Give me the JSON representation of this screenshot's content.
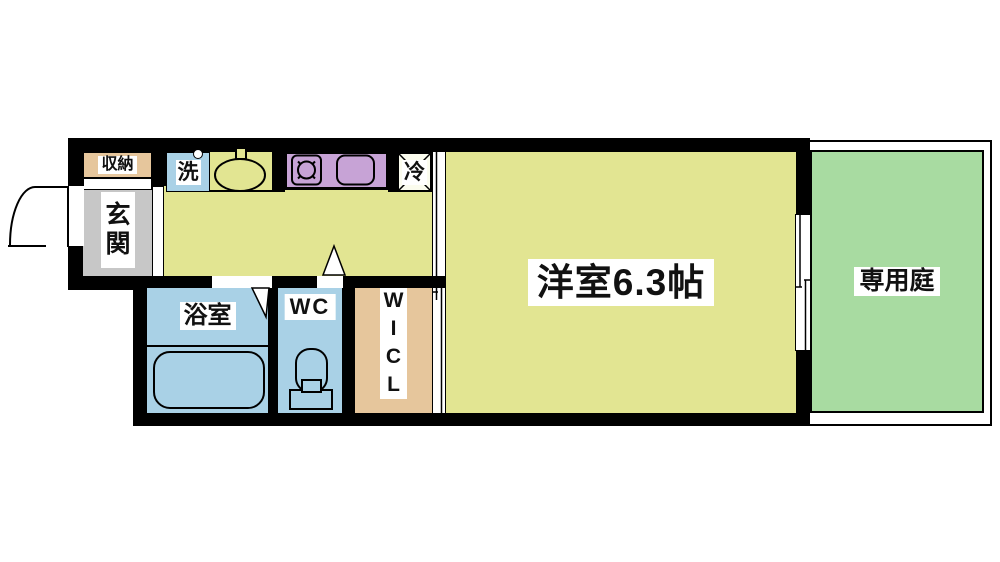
{
  "title": "1K apartment floor plan",
  "colors": {
    "wall": "#000000",
    "yellow": "#e2e592",
    "tan": "#e6c69c",
    "gray": "#c7c7c7",
    "blue": "#a9d1e6",
    "purple": "#c7a3d6",
    "green": "#a8dba1",
    "cream": "#fbfcee"
  },
  "rooms": {
    "storage": {
      "label": "収納"
    },
    "entrance": {
      "label": "玄関",
      "chars": [
        "玄",
        "関"
      ]
    },
    "laundry": {
      "label": "洗"
    },
    "refrigerator": {
      "label": "冷"
    },
    "bathroom": {
      "label": "浴室"
    },
    "wc": {
      "label": "WC"
    },
    "wicl": {
      "label": "WICL",
      "letters": [
        "W",
        "I",
        "C",
        "L"
      ]
    },
    "main_room": {
      "label": "洋室6.3帖"
    },
    "garden": {
      "label": "専用庭"
    }
  }
}
